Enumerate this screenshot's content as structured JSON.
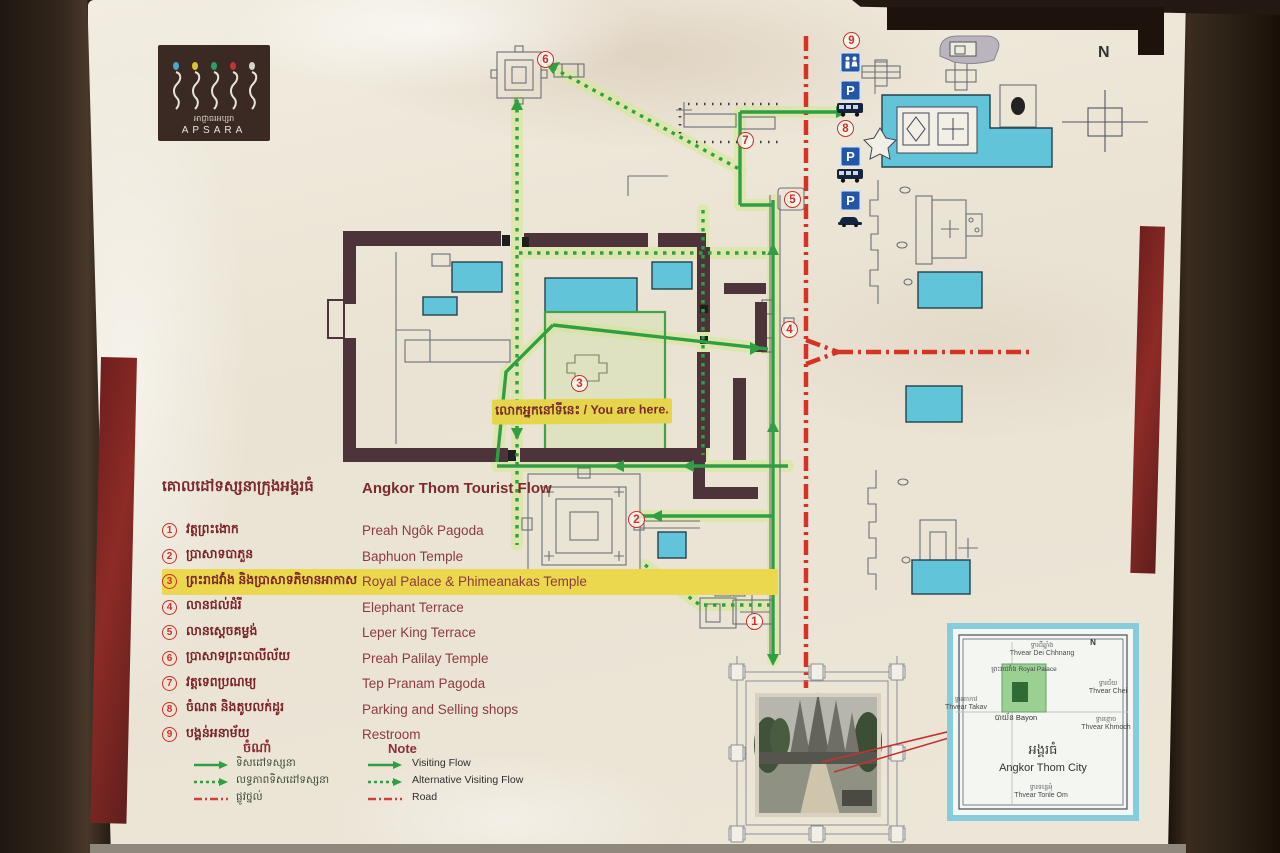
{
  "board": {
    "logo": {
      "brand": "APSARA",
      "brand_khmer": "អាជ្ញាធរអប្សរា"
    },
    "compass_label": "N",
    "legend": {
      "title": {
        "khmer": "គោលដៅទស្សនាក្រុងអង្គរធំ",
        "english": "Angkor Thom Tourist Flow"
      },
      "items": [
        {
          "num": "1",
          "khmer": "វត្តព្រះងោក",
          "english": "Preah Ngôk Pagoda",
          "highlighted": false
        },
        {
          "num": "2",
          "khmer": "ប្រាសាទបាភួន",
          "english": "Baphuon Temple",
          "highlighted": false
        },
        {
          "num": "3",
          "khmer": "ព្រះរាជវាំង និងប្រាសាទភិមានអាកាស",
          "english": "Royal Palace & Phimeanakas Temple",
          "highlighted": true
        },
        {
          "num": "4",
          "khmer": "លានជល់ដំរី",
          "english": "Elephant Terrace",
          "highlighted": false
        },
        {
          "num": "5",
          "khmer": "លានស្តេចគម្លង់",
          "english": "Leper King Terrace",
          "highlighted": false
        },
        {
          "num": "6",
          "khmer": "ប្រាសាទព្រះបាលីល័យ",
          "english": "Preah Palilay Temple",
          "highlighted": false
        },
        {
          "num": "7",
          "khmer": "វត្តទេពប្រណម្យ",
          "english": "Tep Pranam Pagoda",
          "highlighted": false
        },
        {
          "num": "8",
          "khmer": "ចំណត និងតូបលក់ដូរ",
          "english": "Parking and Selling shops",
          "highlighted": false
        },
        {
          "num": "9",
          "khmer": "បង្គន់អនាម័យ",
          "english": "Restroom",
          "highlighted": false
        }
      ],
      "note": {
        "heading": {
          "khmer": "ចំណាំ",
          "english": "Note"
        },
        "rows": [
          {
            "khmer": "ទិសដៅទស្សនា",
            "english": "Visiting Flow",
            "line_style": "solid-green"
          },
          {
            "khmer": "លទ្ធភាពទិសដៅទស្សនា",
            "english": "Alternative Visiting Flow",
            "line_style": "dotted-green"
          },
          {
            "khmer": "ផ្លូវថ្នល់",
            "english": "Road",
            "line_style": "red-dash-dot"
          }
        ]
      }
    },
    "you_are_here": {
      "label": "លោកអ្នកនៅទីនេះ / You are here."
    },
    "map": {
      "markers": [
        {
          "num": "1"
        },
        {
          "num": "2"
        },
        {
          "num": "3"
        },
        {
          "num": "4"
        },
        {
          "num": "5"
        },
        {
          "num": "6"
        },
        {
          "num": "7"
        },
        {
          "num": "8"
        },
        {
          "num": "9"
        }
      ],
      "signs": {
        "parking_letter": "P"
      },
      "colors": {
        "visiting_flow": "#2f9e44",
        "road": "#d63226",
        "water": "#62c4d8",
        "wall": "#4c343a",
        "highlight": "#e5d54b"
      }
    },
    "inset": {
      "title": {
        "khmer": "អង្គរធំ",
        "english": "Angkor Thom City"
      },
      "compass_label": "N",
      "labels": {
        "north_gate": {
          "khmer": "ទ្វារដីឆ្នាំង",
          "english": "Thvear Dei Chhnang"
        },
        "victory_gate": {
          "khmer": "ទ្វារជ័យ",
          "english": "Thvear Chei"
        },
        "death_gate": {
          "khmer": "ទ្វារខ្មោច",
          "english": "Thvear Khmoch"
        },
        "west_gate": {
          "khmer": "ទ្វារតាកាវ",
          "english": "Thvear Takav"
        },
        "south_gate": {
          "khmer": "ទ្វារទន្លេអុំ",
          "english": "Thvear Tonle Om"
        },
        "royal_palace": {
          "khmer": "ព្រះរាជវាំង",
          "english": "Royal Palace"
        },
        "bayon": {
          "khmer": "បាយ័ន",
          "english": "Bayon"
        }
      }
    }
  }
}
